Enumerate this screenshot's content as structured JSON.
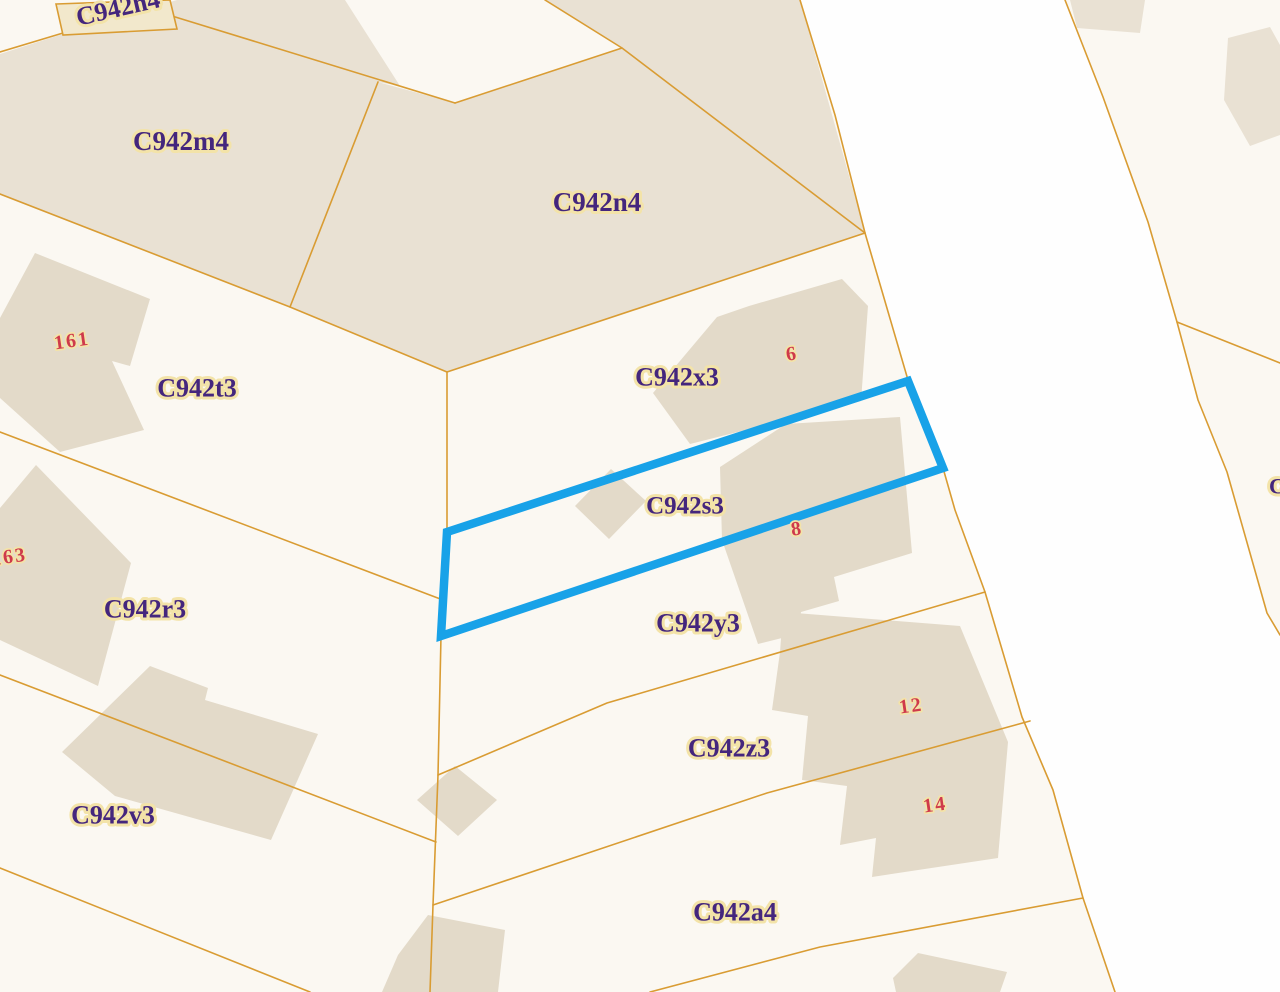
{
  "map": {
    "title": "cadastral-parcel-map",
    "colors": {
      "background": "#fbf8f2",
      "road_fill": "#fefefe",
      "parcel_fill": "#e9e1d3",
      "building_fill": "#e3dac9",
      "boundary": "#d99c33",
      "box_fill": "#f2e8cc",
      "label_text": "#44267d",
      "label_halo": "#f3e3a8",
      "number_text": "#cf3a4b",
      "highlight": "#18a2e8"
    },
    "highlight_parcel": {
      "code": "C942s3",
      "points": "447,532 908,381 943,468 441,636",
      "stroke_width": 8.5
    },
    "road_polygon": "800,0 835,115 865,233 908,380 943,468 955,510 985,592 1022,717 1053,790 1083,898 1115,992 1280,992 1280,635 1267,613 1227,472 1198,400 1177,322 1148,222 1103,97 1065,0",
    "beige_parcels": [
      {
        "name": "parcel-fill-C942m4",
        "points": "0,54 63,34 177,0 345,0 400,86 378,82 290,307 0,195"
      },
      {
        "name": "parcel-fill-C942n4",
        "points": "378,82 455,103 622,48 865,233 447,372 290,307"
      },
      {
        "name": "parcel-fill-north-strip",
        "points": "545,0 800,0 865,233 622,48"
      },
      {
        "name": "parcel-fill-topright-small",
        "points": "1070,0 1145,0 1140,33 1077,28"
      },
      {
        "name": "parcel-fill-topright-large",
        "points": "1224,100 1228,38 1270,27 1280,45 1280,135 1250,146"
      }
    ],
    "buildings": [
      {
        "name": "building-161",
        "points": "35,253 150,299 130,366 112,361 144,430 60,452 0,398 0,318"
      },
      {
        "name": "building-163",
        "points": "0,508 36,465 131,563 98,686 0,640"
      },
      {
        "name": "building-v3",
        "points": "62,752 150,666 208,688 205,700 318,734 271,840 115,796"
      },
      {
        "name": "building-6",
        "points": "653,393 717,317 749,306 842,279 868,306 861,401 690,444"
      },
      {
        "name": "building-8",
        "points": "720,467 786,424 900,417 912,553 834,577 839,601 801,612 798,634 758,644 722,540"
      },
      {
        "name": "building-s3-small",
        "points": "575,506 611,469 646,501 609,539"
      },
      {
        "name": "building-diamond",
        "points": "417,800 455,766 497,800 458,836"
      },
      {
        "name": "building-bottom-center",
        "points": "398,955 428,915 505,930 498,992 382,992"
      },
      {
        "name": "building-12-14",
        "points": "783,612 960,626 1008,742 998,858 872,877 876,838 840,845 847,786 802,780 808,716 772,710 780,652"
      },
      {
        "name": "building-bottom-right",
        "points": "893,978 918,953 1007,972 1000,992 896,992"
      }
    ],
    "boundaries": [
      {
        "name": "boundary-m4-north",
        "points": "0,52 63,33 172,16 455,103"
      },
      {
        "name": "boundary-n4-notch",
        "points": "455,103 622,48 545,0"
      },
      {
        "name": "boundary-n4-northeast",
        "points": "622,48 865,233"
      },
      {
        "name": "boundary-m4-n4-divider",
        "points": "378,82 290,307"
      },
      {
        "name": "boundary-m4-south",
        "points": "0,194 290,307 447,372"
      },
      {
        "name": "boundary-x3-north",
        "points": "447,372 865,233"
      },
      {
        "name": "boundary-west-vertical",
        "points": "447,372 447,533 441,636 438,775 433,905 430,992"
      },
      {
        "name": "boundary-t3-r3",
        "points": "0,432 443,600"
      },
      {
        "name": "boundary-r3-v3",
        "points": "0,675 436,842"
      },
      {
        "name": "boundary-v3-south",
        "points": "0,868 310,992"
      },
      {
        "name": "boundary-y3-z3",
        "points": "438,775 607,703 985,592"
      },
      {
        "name": "boundary-z3-a4",
        "points": "433,905 767,793 1030,721"
      },
      {
        "name": "boundary-a4-south",
        "points": "650,992 820,947 1083,898"
      },
      {
        "name": "boundary-road-west",
        "points": "800,0 835,115 865,233 908,380 943,468 955,510 985,592 1022,717 1053,790 1083,898 1115,992"
      },
      {
        "name": "boundary-road-east",
        "points": "1065,0 1103,97 1148,222 1177,322 1198,400 1227,472 1267,613 1280,635"
      },
      {
        "name": "boundary-east-branch",
        "points": "1177,322 1280,363"
      }
    ],
    "h4_box": {
      "points": "56,4 170,0 177,29 63,35"
    },
    "parcel_labels": [
      {
        "text": "C942h4",
        "x": 118,
        "y": 8,
        "rotate": -13,
        "size": 26
      },
      {
        "text": "C942m4",
        "x": 181,
        "y": 141,
        "rotate": 0,
        "size": 27
      },
      {
        "text": "C942n4",
        "x": 597,
        "y": 202,
        "rotate": 0,
        "size": 27
      },
      {
        "text": "C942t3",
        "x": 197,
        "y": 388,
        "rotate": 0,
        "size": 26
      },
      {
        "text": "C942x3",
        "x": 677,
        "y": 377,
        "rotate": 0,
        "size": 26
      },
      {
        "text": "C942s3",
        "x": 685,
        "y": 506,
        "rotate": 0,
        "size": 25
      },
      {
        "text": "C942r3",
        "x": 145,
        "y": 609,
        "rotate": 0,
        "size": 26
      },
      {
        "text": "C942y3",
        "x": 698,
        "y": 623,
        "rotate": 0,
        "size": 26
      },
      {
        "text": "C942z3",
        "x": 729,
        "y": 748,
        "rotate": 0,
        "size": 26
      },
      {
        "text": "C942v3",
        "x": 113,
        "y": 815,
        "rotate": 0,
        "size": 26
      },
      {
        "text": "C942a4",
        "x": 735,
        "y": 912,
        "rotate": 0,
        "size": 26
      },
      {
        "text": "C",
        "x": 1277,
        "y": 486,
        "rotate": 0,
        "size": 22
      }
    ],
    "house_numbers": [
      {
        "text": "161",
        "x": 72,
        "y": 341,
        "rotate": -8
      },
      {
        "text": "163",
        "x": 9,
        "y": 557,
        "rotate": -8
      },
      {
        "text": "6",
        "x": 792,
        "y": 354,
        "rotate": -8
      },
      {
        "text": "8",
        "x": 797,
        "y": 529,
        "rotate": -8
      },
      {
        "text": "12",
        "x": 911,
        "y": 706,
        "rotate": -8
      },
      {
        "text": "14",
        "x": 935,
        "y": 805,
        "rotate": -8
      }
    ]
  }
}
